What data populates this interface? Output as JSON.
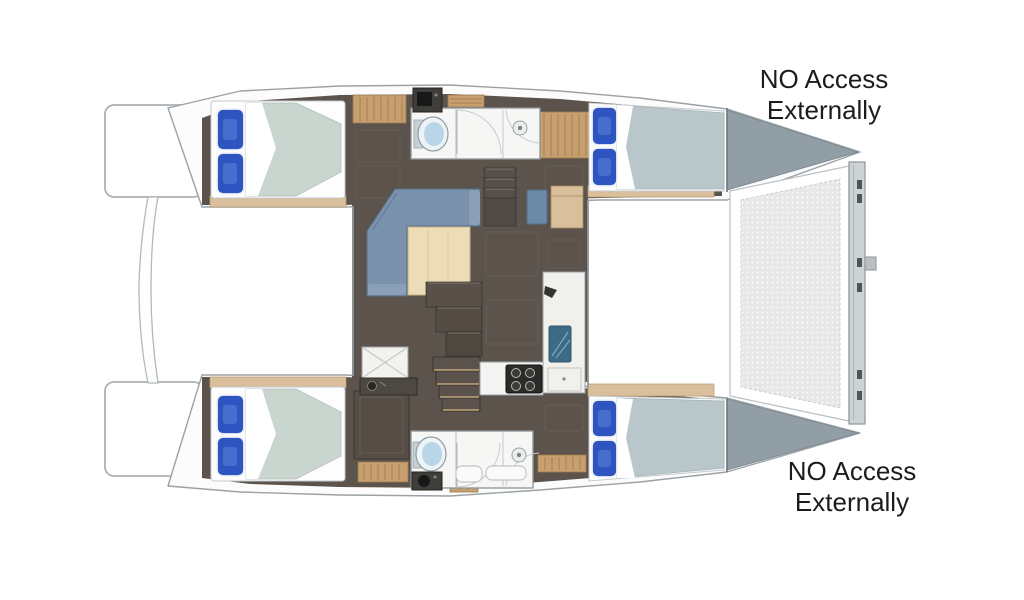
{
  "page": {
    "type": "catamaran-floor-plan",
    "background": "#ffffff"
  },
  "annotations": {
    "top": {
      "line1": "NO Access",
      "line2": "Externally"
    },
    "bottom": {
      "line1": "NO Access",
      "line2": "Externally"
    }
  },
  "colors": {
    "hull_outline": "#9aa2a6",
    "hull_deck_white": "#fcfcfd",
    "floor_dark": "#5c544c",
    "deck_wood": "#d9bf9b",
    "bench_wood": "#c89f6e",
    "table_wood": "#ecdcb8",
    "sofa_blue": "#7b92ac",
    "nav_seat_blue": "#6d89a8",
    "pillow_blue": "#2d54c0",
    "mattress_aft": "#c9d6cf",
    "mattress_fwd": "#b9c7cb",
    "bathroom_white": "#f6f6f4",
    "toilet_blue": "#b9d5e8",
    "sink_teal": "#3d6a84",
    "stove_black": "#2b2b29",
    "bow_locker_gray": "#919ea6",
    "beam_gray": "#cdd2d5",
    "trampoline_mesh_bg": "#e6e7e8",
    "label_text": "#1c1c1c"
  },
  "components": [
    "stern-platform-top",
    "stern-platform-bottom",
    "transom-connector",
    "hull-top",
    "hull-bottom",
    "salon-floor",
    "bed-aft-top",
    "bed-fwd-top",
    "bed-aft-bottom",
    "bed-fwd-bottom",
    "bathroom-top",
    "bathroom-bottom",
    "toilet-top",
    "toilet-bottom",
    "shower-drain-top",
    "shower-drain-bottom",
    "vanity-top",
    "vanity-bottom",
    "bench-top-left",
    "bench-top-right",
    "bench-bottom-left",
    "bench-bottom-right",
    "salon-sofa",
    "salon-table",
    "nav-seat",
    "chart-table",
    "stairs-to-top-hull",
    "stairs-to-bottom-hull",
    "mast-steps",
    "galley-counter",
    "galley-stove",
    "galley-sink-unit",
    "storage-box",
    "wardrobe",
    "bow-locker-top",
    "bow-locker-bottom",
    "trampoline",
    "bow-crossbeam"
  ]
}
